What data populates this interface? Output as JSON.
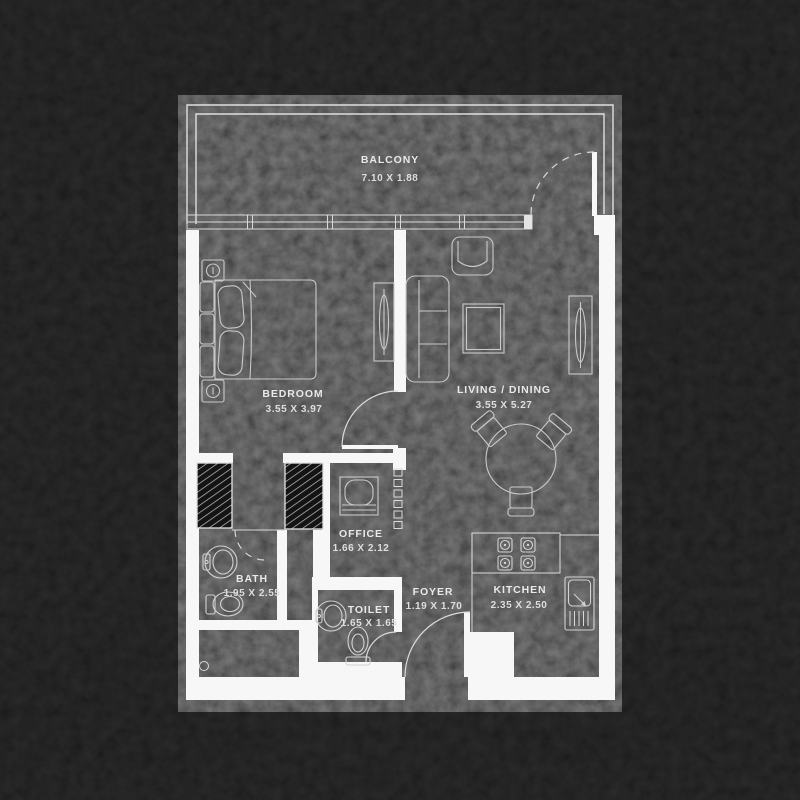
{
  "plan_title": "apartment-floor-plan",
  "colors": {
    "background": "#0d0d0e",
    "wall": "#f7f7f7",
    "furniture_line": "#c9c9c9",
    "text": "#e9e9e9"
  },
  "rooms": [
    {
      "id": "balcony",
      "name": "BALCONY",
      "dims": "7.10 X 1.88"
    },
    {
      "id": "bedroom",
      "name": "BEDROOM",
      "dims": "3.55 X 3.97"
    },
    {
      "id": "living-dining",
      "name": "LIVING / DINING",
      "dims": "3.55 X 5.27"
    },
    {
      "id": "office",
      "name": "OFFICE",
      "dims": "1.66 X 2.12"
    },
    {
      "id": "bath",
      "name": "BATH",
      "dims": "1.95 X 2.55"
    },
    {
      "id": "toilet",
      "name": "TOILET",
      "dims": "1.65 X 1.65"
    },
    {
      "id": "foyer",
      "name": "FOYER",
      "dims": "1.19 X 1.70"
    },
    {
      "id": "kitchen",
      "name": "KITCHEN",
      "dims": "2.35 X 2.50"
    }
  ]
}
